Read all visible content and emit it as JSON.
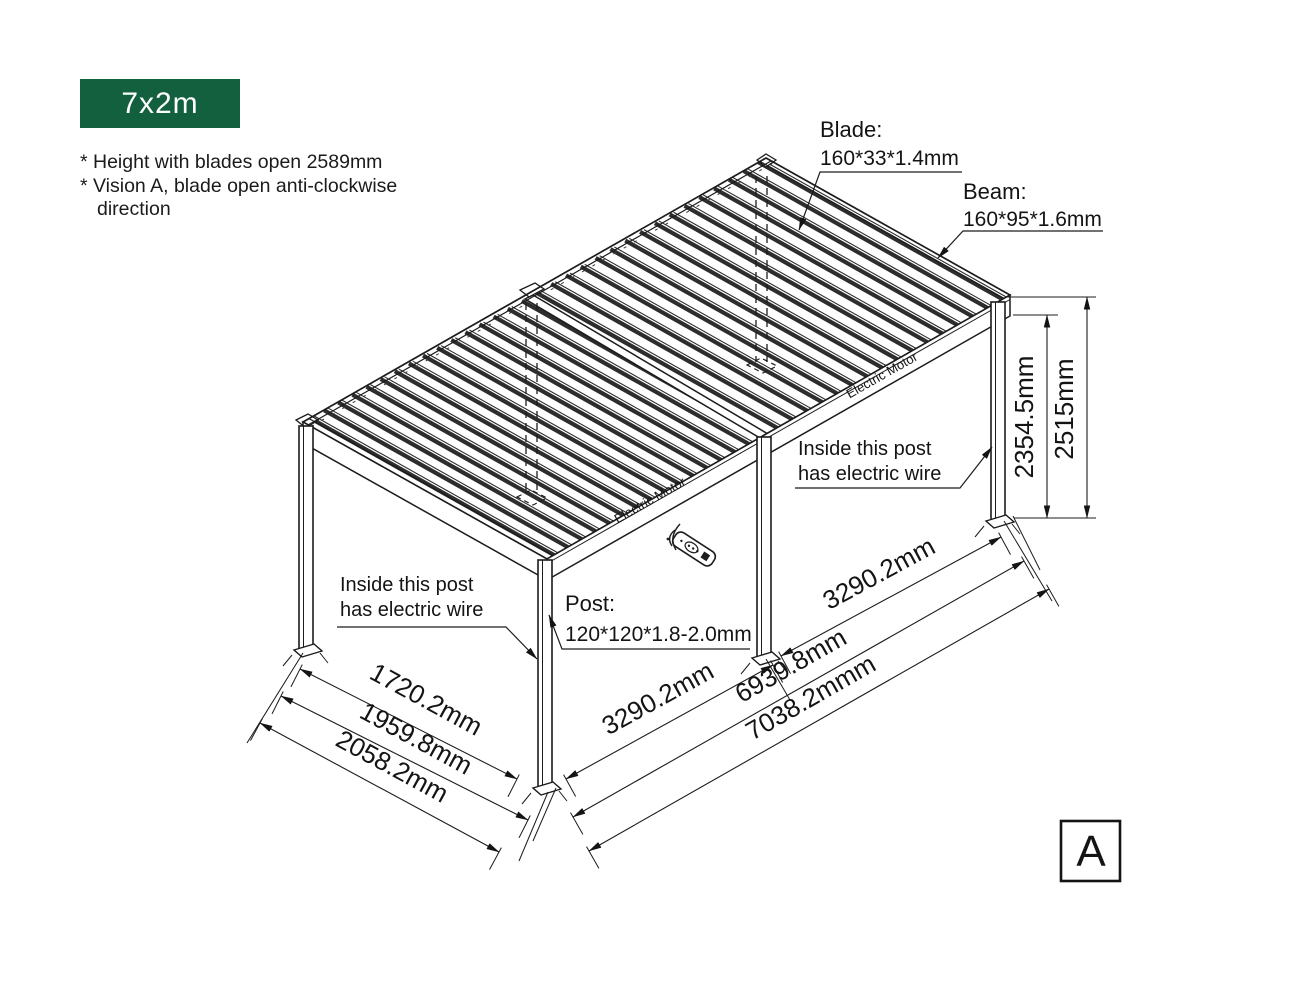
{
  "badge": {
    "label": "7x2m",
    "bg": "#13603f"
  },
  "notes": {
    "line1": "* Height with blades open 2589mm",
    "line2": "* Vision A, blade open anti-clockwise",
    "line3": "direction"
  },
  "callouts": {
    "blade": {
      "title": "Blade:",
      "spec": "160*33*1.4mm"
    },
    "beam": {
      "title": "Beam:",
      "spec": "160*95*1.6mm"
    },
    "post": {
      "title": "Post:",
      "spec": "120*120*1.8-2.0mm"
    },
    "wire_left": {
      "line1": "Inside this post",
      "line2": "has electric wire"
    },
    "wire_right": {
      "line1": "Inside this post",
      "line2": "has electric wire"
    },
    "motor_left": "Electric Motor",
    "motor_right": "Electric Motor"
  },
  "dimensions": {
    "post_height": "2354.5mm",
    "total_height": "2515mm",
    "depth_inner": "1720.2mm",
    "depth_mid": "1959.8mm",
    "depth_outer": "2058.2mm",
    "bay_left": "3290.2mm",
    "bay_right": "3290.2mm",
    "length_inner": "6939.8mm",
    "length_outer": "7038.2mmm"
  },
  "view_label": "A"
}
